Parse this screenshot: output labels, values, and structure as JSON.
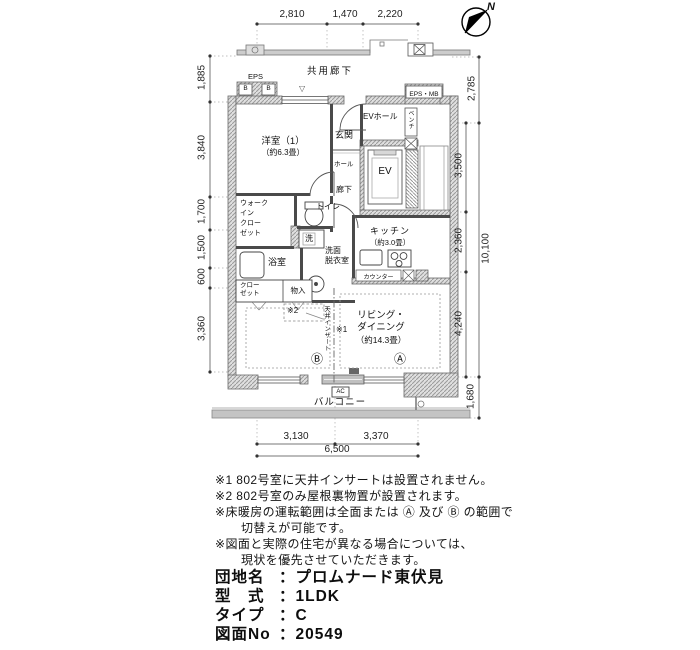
{
  "compass": {
    "label": "N"
  },
  "corridor": {
    "label": "共用廊下"
  },
  "shafts": {
    "eps": "EPS",
    "eps_b1": "B",
    "eps_b2": "B",
    "eps_mb": "EPS・MB"
  },
  "rooms": {
    "yoshitsu_name": "洋室（1）",
    "yoshitsu_size": "（約6.3畳）",
    "genkan": "玄関",
    "hall": "ホール",
    "ev_hall": "EVホール",
    "bench": "ベンチ",
    "ev": "EV",
    "rouka": "廊下",
    "toilet": "トイレ",
    "wic_l1": "ウォーク",
    "wic_l2": "イン",
    "wic_l3": "クロー",
    "wic_l4": "ゼット",
    "laundry": "洗",
    "bath": "浴室",
    "senmen_l1": "洗面",
    "senmen_l2": "脱衣室",
    "kitchen_name": "キッチン",
    "kitchen_size": "（約3.0畳）",
    "counter": "カウンター",
    "closet_l1": "クロー",
    "closet_l2": "ゼット",
    "storage": "物入",
    "living_l1": "リビング・",
    "living_l2": "ダイニング",
    "living_size": "（約14.3畳）",
    "balcony": "バルコニー",
    "ac": "AC",
    "mark_a": "Ⓐ",
    "mark_b": "Ⓑ",
    "ref1": "※1",
    "ref2": "※2",
    "ceiling_insert": "天井インサート",
    "window_marker": "▽"
  },
  "dims": {
    "top": [
      "2,810",
      "1,470",
      "2,220"
    ],
    "left": [
      "1,885",
      "3,840",
      "1,700",
      "1,500",
      "600",
      "3,360"
    ],
    "right": [
      "2,785",
      "3,500",
      "2,360",
      "4,240",
      "1,680"
    ],
    "right_total": "10,100",
    "bottom": [
      "3,130",
      "3,370"
    ],
    "bottom_total": "6,500"
  },
  "notes": [
    "※1 802号室に天井インサートは設置されません。",
    "※2 802号室のみ屋根裏物置が設置されます。",
    "※床暖房の運転範囲は全面または Ⓐ 及び Ⓑ の範囲で",
    "切替えが可能です。",
    "※図面と実際の住宅が異なる場合については、",
    "現状を優先させていただきます。"
  ],
  "title_block": {
    "sep": "：",
    "rows": [
      {
        "label": "団地名",
        "value": "プロムナード東伏見"
      },
      {
        "label": "型　式",
        "value": "1LDK"
      },
      {
        "label": "タイプ",
        "value": "C"
      },
      {
        "label": "図面No",
        "value": "20549"
      }
    ]
  }
}
